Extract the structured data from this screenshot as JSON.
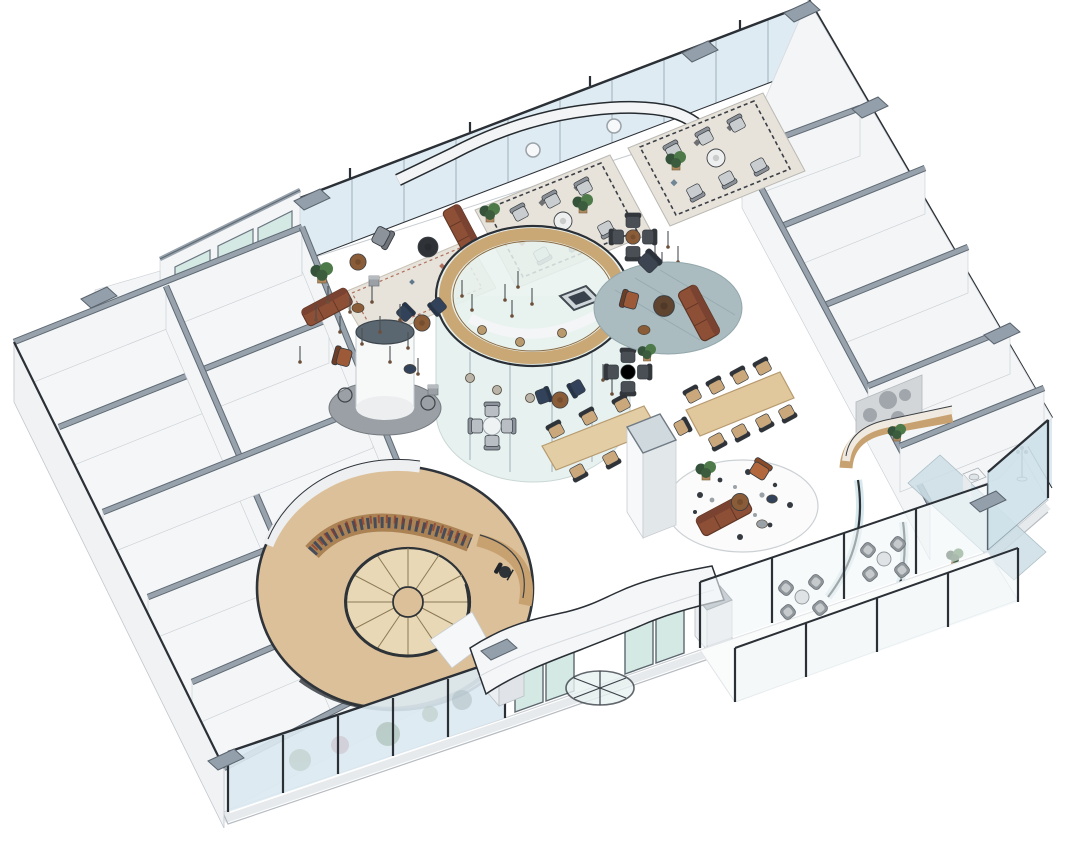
{
  "meta": {
    "description": "Axonometric 3D rendering of an open-plan office lounge floor",
    "view": "isometric cutaway floor plan",
    "width_px": 1080,
    "height_px": 848
  },
  "palette": {
    "floor_white": "#ffffff",
    "outline": "#2b3036",
    "wall_cap": "#97a2ac",
    "wall_cap_dark": "#5f6a74",
    "wall_white": "#f3f5f6",
    "wall_face": "#eceff2",
    "glass_blue": "#dce9f1",
    "glass_teal": "#d5e9e4",
    "glass_light": "#eef4f8",
    "wood_light": "#dcc09a",
    "wood_mid": "#c8a170",
    "wood_dark": "#8a5c38",
    "stair_tread": "#e8d8b6",
    "leather": "#8d4f36",
    "leather_dark": "#5e3524",
    "navy": "#31425a",
    "charcoal": "#4a4f55",
    "chair_gray": "#c2c7cb",
    "rug_cream": "#e7e3da",
    "rug_gray": "#aabcc0",
    "terrazzo": "#fbfbfb",
    "plant_green": "#4e7a4a",
    "plant_dark": "#35523a",
    "metal": "#4a4f54",
    "canopy": "#f4f6f7"
  },
  "areas": {
    "building": {
      "label": "Isometric office floor plate"
    },
    "facade_nw": {
      "label": "North-west glazed curtain wall"
    },
    "facade_ne": {
      "label": "North-east glazed curtain wall"
    },
    "facade_se": {
      "label": "South-east facade with entrance and terrace"
    },
    "left_wing": {
      "label": "Back-of-house room block (west wing)"
    },
    "right_wing": {
      "label": "Meeting room block (east wing)"
    },
    "corridor_wall": {
      "label": "Curved corridor wall"
    },
    "lounge_rugs": {
      "label": "Patterned rug lounge with striped armchairs"
    },
    "banquette": {
      "label": "Runner rug banquette with leather sofas"
    },
    "glass_pod": {
      "label": "Circular glass meeting pod with timber ring"
    },
    "column_lounge": {
      "label": "Round column lounge with pendant lights"
    },
    "cafe_seating": {
      "label": "Cafe table seating clusters"
    },
    "gray_rug_lounge": {
      "label": "Round gray rug sofa group"
    },
    "terrazzo_rug_lounge": {
      "label": "Round terrazzo rug sofa group"
    },
    "communal_table": {
      "label": "Communal work table"
    },
    "dining_table": {
      "label": "Long dining table for ten"
    },
    "pillar": {
      "label": "Tall white pillar volume"
    },
    "stair_platform": {
      "label": "Circular timber platform with spiral stair"
    },
    "bookshelf": {
      "label": "Curved bookshelf wall"
    },
    "spiral_stair": {
      "label": "Spiral staircase"
    },
    "reading_desk": {
      "label": "Curved reading desk with task chair"
    },
    "entrance": {
      "label": "Revolving door entrance with wavy canopy"
    },
    "terrace": {
      "label": "Outdoor terrace with wicker chairs"
    },
    "balustrade": {
      "label": "Glass balustrade with foliage reflections"
    },
    "pantry_counter": {
      "label": "Curved timber pantry counter"
    },
    "art_wall": {
      "label": "Blurred art mural wall"
    },
    "glass_partition": {
      "label": "Curved glass partitions"
    },
    "coat_stand": {
      "label": "Coat stand"
    },
    "plants": {
      "label": "Potted plants"
    },
    "pendant_lights": {
      "label": "Clusters of pendant light drops"
    }
  }
}
